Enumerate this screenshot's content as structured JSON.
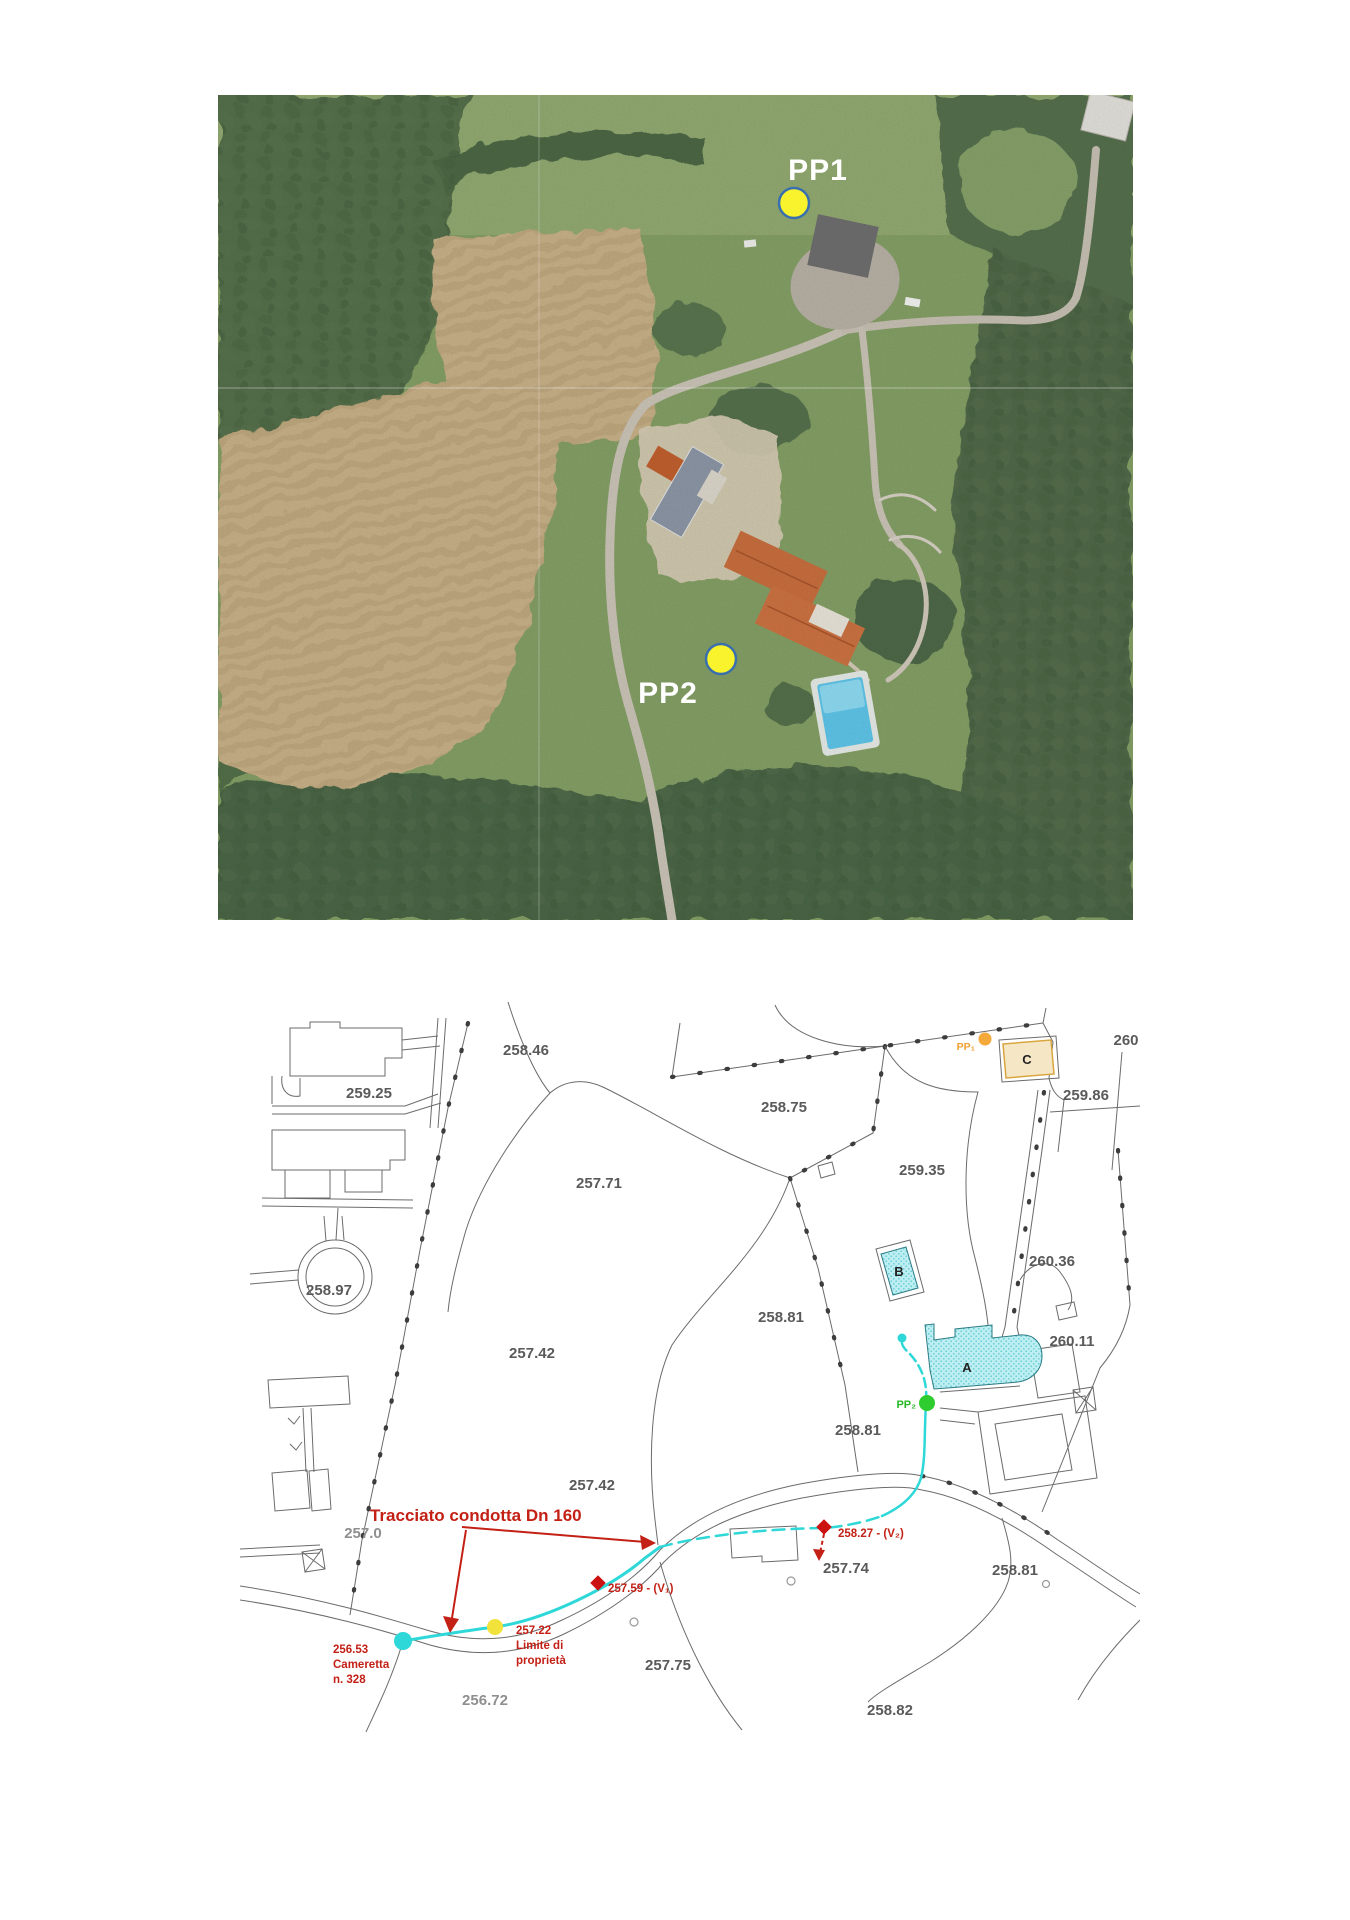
{
  "page": {
    "background": "#ffffff"
  },
  "photo": {
    "pp1_label": "PP1",
    "pp2_label": "PP2",
    "marker_fill": "#f8f32c",
    "marker_stroke": "#3a6fae"
  },
  "map": {
    "elevations": [
      "258.46",
      "259.25",
      "258.75",
      "257.71",
      "259.35",
      "258.97",
      "260.36",
      "258.81",
      "257.42",
      "260.11",
      "258.81",
      "257.42",
      "257.0",
      "257.74",
      "258.81",
      "257.75",
      "256.72",
      "258.82",
      "259.86",
      "260"
    ],
    "buildings": {
      "a": "A",
      "b": "B",
      "c": "C"
    },
    "markers": {
      "pp1": "PP₁",
      "pp2": "PP₂"
    },
    "annotations": {
      "tracciato": "Tracciato condotta Dn 160",
      "cameretta_l1": "256.53",
      "cameretta_l2": "Cameretta",
      "cameretta_l3": "n. 328",
      "limite_l1": "257.22",
      "limite_l2": "Limite di",
      "limite_l3": "proprietà",
      "v1": "257.59 - (V₁)",
      "v2": "258.27 - (V₂)"
    },
    "colors": {
      "pipeline": "#2fd8d8",
      "annotation_red": "#c32016",
      "pp1_dot": "#f5a93a",
      "pp2_dot": "#2ecc2e",
      "valve_dot": "#cc1111",
      "chamber_dot": "#2fd8d8",
      "property_limit_dot": "#f2e23c",
      "building_cyan": "#a5e6ec",
      "building_tan": "#f5e7c6"
    }
  }
}
